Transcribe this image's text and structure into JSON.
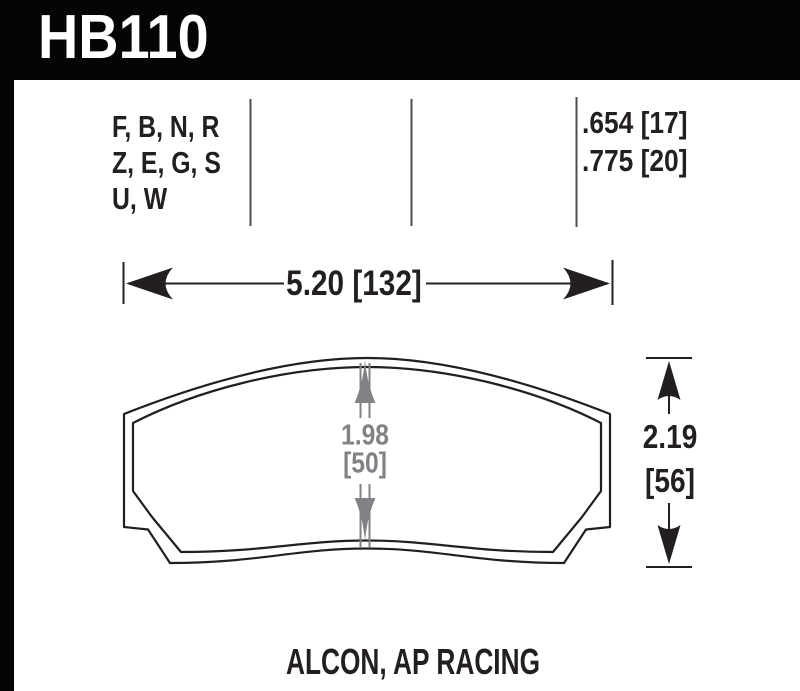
{
  "part": {
    "number": "HB110"
  },
  "compound_codes": {
    "line1": "F, B, N, R",
    "line2": "Z, E, G, S",
    "line3": "U, W"
  },
  "pad_thickness": {
    "line1": ".654 [17]",
    "line2": ".775 [20]"
  },
  "dimensions": {
    "overall_width": "5.20 [132]",
    "overall_height_in": "2.19",
    "overall_height_mm": "[56]",
    "center_height_in": "1.98",
    "center_height_mm": "[50]"
  },
  "application": "ALCON, AP RACING",
  "colors": {
    "frame_black": "#050505",
    "ink_black": "#231f20",
    "dim_gray": "#808285",
    "separator_gray": "#4d4d4f"
  }
}
